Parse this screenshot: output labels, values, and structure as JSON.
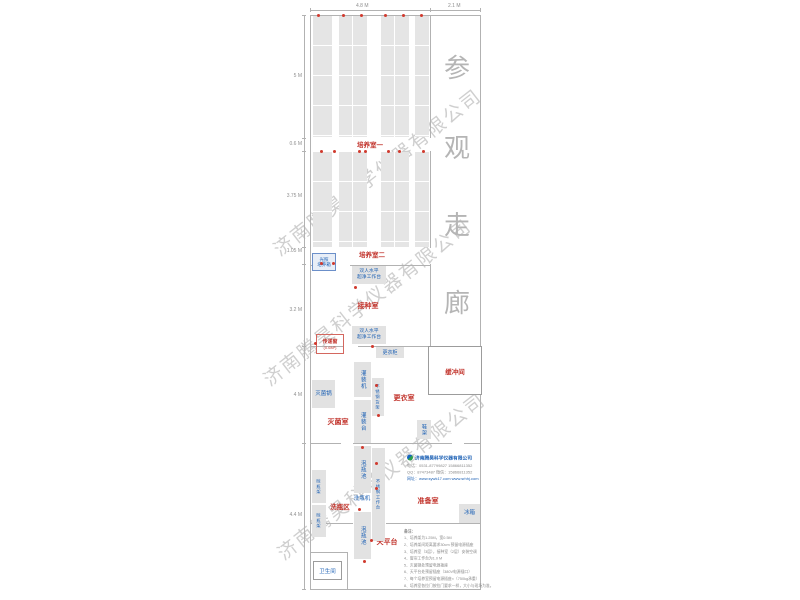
{
  "watermark": {
    "text": "济南腾昊科学仪器有限公司"
  },
  "corridor": {
    "name": "参观走廊",
    "chars": [
      "参",
      "观",
      "走",
      "廊"
    ]
  },
  "dimensions": {
    "top_width_rooms": "4.8 M",
    "top_width_corridor": "2.1 M",
    "left": [
      "5 M",
      "0.6 M",
      "3.75 M",
      "1.05 M",
      "3.2 M",
      "4 M",
      "4.4 M"
    ]
  },
  "rooms": {
    "culture1": "培养室一",
    "culture2": "培养室二",
    "inoculation": "接种室",
    "sterilization": "灭菌室",
    "changing": "更衣室",
    "buffer": "缓冲间",
    "washing_area": "洗瓶区",
    "prep": "准备室",
    "toilet": "卫生间",
    "balance": "天平台"
  },
  "equipment": {
    "light_incubator_line1": "光照",
    "light_incubator_line2": "培养箱",
    "clean_bench_line1": "双人水平",
    "clean_bench_line2": "超净工作台",
    "pass_window": "传递窗",
    "pass_window_size": "(0.6M²)",
    "wardrobe": "更衣柜",
    "filling_machine": "灌装机",
    "ss_shelf": "不锈钢货架",
    "autoclave": "灭菌锅",
    "filling_table": "灌装台",
    "shoe_rack": "鞋架",
    "soak_pool": "泡瓶池",
    "ss_worktable": "不锈钢工作台",
    "bottle_washer": "洗瓶机",
    "drying_rack": "晾瓶架",
    "fridge": "冰箱"
  },
  "logo": {
    "company": "济南腾昊科学仪器有限公司",
    "phone_line": "电话：0531-87799827  15866811352",
    "qq_line": "QQ：87473487  微信：15866811352",
    "web_line": "网址：www.sywk17.com  www.srhhj.com"
  },
  "notes": {
    "title": "备注：",
    "items": [
      "1、培养架为1.25M，宽0.5M",
      "2、培养架间距离要求30cm 预留电源插座",
      "3、培养室（3层），接种室（2层）安装空调",
      "4、窗帘工作台为1.0 M",
      "5、灭菌锅处预留电源插座",
      "6、天平台处预留插座（380V电源插口）",
      "7、每个培养室预留电源插座×（750kg承重）",
      "8、培养室各拉门按拉门要求一样，大小与现场为准。"
    ]
  },
  "colors": {
    "label_red": "#c2342c",
    "label_blue": "#1a5fb4",
    "wall_gray": "#b2b2b2",
    "band_gray": "#e5e5e5",
    "watermark_gray": "#c7c7c7"
  }
}
